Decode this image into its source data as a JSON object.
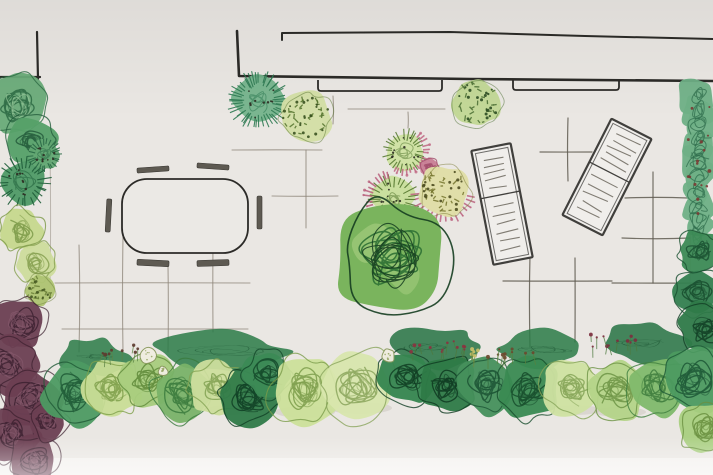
{
  "scene": {
    "description": "Hand-drawn garden landscape plan, top view, watercolor and ink sketch",
    "canvas": {
      "width": 713,
      "height": 475
    }
  },
  "palette": {
    "paper": "#eae7e3",
    "paper_light": "#f3f1ee",
    "ink": "#2c2b28",
    "pencil_light": "#8c8478",
    "pencil_dark": "#5f5a50",
    "seat": "#5e5a52",
    "lounger_frame": "#403f3c",
    "lounger_slat": "#7b766d",
    "lounger_fill": "#f0eeeb",
    "table_fill": "#ebe9e5",
    "pink": "#bd6280",
    "shadow": "#c2bdb5"
  },
  "building": {
    "rooftick": [
      [
        282,
        40
      ],
      [
        282,
        33
      ],
      [
        450,
        32
      ],
      [
        585,
        36
      ],
      [
        713,
        39
      ]
    ],
    "wall": [
      [
        237,
        31
      ],
      [
        239,
        76
      ],
      [
        470,
        79
      ],
      [
        713,
        81
      ]
    ],
    "corner_left_h": [
      [
        0,
        77
      ],
      [
        40,
        77
      ]
    ],
    "corner_left_v": [
      [
        37,
        32
      ],
      [
        38,
        79
      ]
    ],
    "doors": [
      {
        "name": "door-threshold-left",
        "x": 318,
        "y": 80,
        "w": 124,
        "h": 11
      },
      {
        "name": "door-threshold-right",
        "x": 513,
        "y": 79,
        "w": 106,
        "h": 11
      }
    ],
    "bed_edges": [
      [
        50,
        150,
        50,
        285
      ],
      [
        689,
        120,
        690,
        300
      ]
    ]
  },
  "paving": {
    "light_lines": [
      [
        79,
        245,
        79,
        352
      ],
      [
        123,
        237,
        123,
        352
      ],
      [
        168,
        265,
        168,
        352
      ],
      [
        213,
        243,
        213,
        332
      ],
      [
        55,
        283,
        250,
        283
      ],
      [
        62,
        329,
        248,
        329
      ],
      [
        232,
        150,
        322,
        150
      ],
      [
        306,
        150,
        306,
        228
      ],
      [
        272,
        196,
        338,
        196
      ],
      [
        348,
        109,
        445,
        109
      ],
      [
        408,
        112,
        408,
        128
      ],
      [
        333,
        96,
        333,
        124
      ]
    ],
    "dark_lines": [
      [
        540,
        152,
        592,
        152
      ],
      [
        568,
        118,
        568,
        181
      ],
      [
        625,
        198,
        688,
        198
      ],
      [
        653,
        172,
        653,
        283
      ],
      [
        622,
        238,
        690,
        238
      ],
      [
        530,
        255,
        530,
        347
      ],
      [
        575,
        258,
        575,
        342
      ],
      [
        503,
        281,
        612,
        281
      ],
      [
        612,
        283,
        702,
        283
      ]
    ]
  },
  "furniture": {
    "table": {
      "name": "dining-table",
      "x": 122,
      "y": 179,
      "w": 126,
      "h": 74,
      "r": 25
    },
    "seats": [
      {
        "name": "bench-top-left",
        "x": 137,
        "y": 167,
        "w": 32,
        "h": 5,
        "a": -4
      },
      {
        "name": "bench-top-right",
        "x": 197,
        "y": 164,
        "w": 32,
        "h": 5,
        "a": 4
      },
      {
        "name": "bench-bottom-left",
        "x": 137,
        "y": 260,
        "w": 32,
        "h": 6,
        "a": 3
      },
      {
        "name": "bench-bottom-right",
        "x": 197,
        "y": 260,
        "w": 32,
        "h": 6,
        "a": -2
      },
      {
        "name": "bench-left",
        "x": 106,
        "y": 199,
        "w": 5,
        "h": 33,
        "a": 3
      },
      {
        "name": "bench-right",
        "x": 257,
        "y": 196,
        "w": 5,
        "h": 33,
        "a": 0
      }
    ],
    "loungers": [
      {
        "name": "sun-lounger-left",
        "cx": 502,
        "cy": 204,
        "w": 40,
        "h": 116,
        "a": -11,
        "div": 0.42,
        "slats_top": 5,
        "slats_bottom": 6
      },
      {
        "name": "sun-lounger-right",
        "cx": 607,
        "cy": 177,
        "w": 45,
        "h": 108,
        "a": 27,
        "div": 0.45,
        "slats_top": 5,
        "slats_bottom": 5
      }
    ]
  },
  "shadows": [
    [
      305,
      412,
      30,
      6
    ],
    [
      360,
      408,
      32,
      6
    ],
    [
      230,
      410,
      24,
      5
    ],
    [
      150,
      400,
      22,
      5
    ],
    [
      575,
      410,
      26,
      5
    ],
    [
      620,
      412,
      26,
      5
    ]
  ],
  "bands": [
    {
      "x0": 62,
      "x1": 130,
      "y": 357,
      "h": 9,
      "color": "#2a7a46"
    },
    {
      "x0": 155,
      "x1": 285,
      "y": 352,
      "h": 10,
      "color": "#2a7a46"
    },
    {
      "x0": 388,
      "x1": 478,
      "y": 347,
      "h": 10,
      "color": "#267243"
    },
    {
      "x0": 498,
      "x1": 590,
      "y": 350,
      "h": 9,
      "color": "#2a7a46"
    },
    {
      "x0": 598,
      "x1": 688,
      "y": 344,
      "h": 10,
      "color": "#267243"
    }
  ],
  "plants": [
    {
      "name": "left-bed-shrub-1",
      "type": "scribble",
      "cx": 17,
      "cy": 105,
      "r": 30,
      "base": "#69ab78",
      "dark": "#2c6a43",
      "light": "#9ccb9e"
    },
    {
      "name": "left-bed-shrub-2",
      "type": "scribble",
      "cx": 32,
      "cy": 142,
      "r": 26,
      "base": "#55a068",
      "dark": "#245c3c"
    },
    {
      "name": "left-bed-shrub-3",
      "type": "spiky",
      "cx": 24,
      "cy": 182,
      "r": 24,
      "base": "#4f9a66",
      "spike": "#1e5c38"
    },
    {
      "name": "left-bed-shrub-4",
      "type": "spiky",
      "cx": 44,
      "cy": 155,
      "r": 16,
      "base": "#63a873",
      "spike": "#2a6a46"
    },
    {
      "name": "left-bed-shrub-5",
      "type": "lightscribble",
      "cx": 20,
      "cy": 230,
      "r": 22,
      "base": "#c6d88d",
      "dark": "#7d9a49"
    },
    {
      "name": "left-bed-shrub-6",
      "type": "lightscribble",
      "cx": 36,
      "cy": 262,
      "r": 20,
      "base": "#cddc9c",
      "dark": "#86a050"
    },
    {
      "name": "left-bed-shrub-7",
      "type": "textured",
      "cx": 40,
      "cy": 290,
      "r": 15,
      "base": "#aec473",
      "mark": "#6b8039",
      "dot": "#465922"
    },
    {
      "name": "left-bed-maroon-mass",
      "type": "mass",
      "base": "#6b3f52",
      "dark": "#3a1f2e",
      "light": "#8d6073",
      "subs": [
        [
          20,
          322,
          26
        ],
        [
          8,
          365,
          28
        ],
        [
          30,
          398,
          30
        ],
        [
          12,
          436,
          28
        ],
        [
          34,
          460,
          24
        ],
        [
          48,
          420,
          20
        ]
      ]
    },
    {
      "name": "tree-teal-spiky",
      "type": "spiky",
      "cx": 258,
      "cy": 101,
      "r": 27,
      "base": "#74b38b",
      "spike": "#2e7a52",
      "dense": true
    },
    {
      "name": "tree-textured-left",
      "type": "textured",
      "cx": 306,
      "cy": 117,
      "r": 26,
      "base": "#d2dfa5",
      "mark": "#55742e",
      "dot": "#3a5220"
    },
    {
      "name": "tree-textured-right",
      "type": "textured",
      "cx": 477,
      "cy": 103,
      "r": 24,
      "base": "#c1d795",
      "mark": "#4a6e32",
      "dot": "#2e4e23"
    },
    {
      "name": "shrub-spiky-upper",
      "type": "spiky",
      "cx": 405,
      "cy": 151,
      "r": 20,
      "base": "#cfe2a1",
      "spike": "#5a7d36",
      "fringe": {
        "a0": -50,
        "a1": 120,
        "color": "#c06883"
      }
    },
    {
      "name": "pink-tuft",
      "type": "lightscribble",
      "cx": 429,
      "cy": 167,
      "r": 9,
      "base": "#c87e95",
      "dark": "#a34e6c"
    },
    {
      "name": "shrub-spiky-lower",
      "type": "spiky",
      "cx": 393,
      "cy": 199,
      "r": 23,
      "base": "#c8de9b",
      "spike": "#54772e",
      "fringe": {
        "a0": 100,
        "a1": 260,
        "color": "#b85e7b"
      }
    },
    {
      "name": "shrub-yellow-textured",
      "type": "textured",
      "cx": 444,
      "cy": 191,
      "r": 26,
      "base": "#dfdea7",
      "mark": "#75752e",
      "dot": "#4e4e21",
      "fringe": {
        "a0": 10,
        "a1": 175,
        "color": "#bc6380"
      }
    },
    {
      "name": "shrub-cloud-topiary",
      "type": "cloud",
      "cx": 392,
      "cy": 257,
      "r": 56,
      "base": "#7ab45d",
      "dark": "#2e7034",
      "ink": "#153d20",
      "light": "#a6cd80"
    },
    {
      "name": "right-hedge-top",
      "type": "hedge",
      "x": 684,
      "w": 29,
      "y0": 88,
      "y1": 232,
      "base": "#6fb086",
      "dark": "#2b6a49",
      "berry": "#7a3a33"
    },
    {
      "name": "right-hedge-mid-1",
      "type": "scribble",
      "cx": 700,
      "cy": 252,
      "r": 22,
      "base": "#3c8a55",
      "dark": "#1b5232"
    },
    {
      "name": "right-hedge-mid-2",
      "type": "scribble",
      "cx": 697,
      "cy": 292,
      "r": 24,
      "base": "#348050",
      "dark": "#174c2e"
    },
    {
      "name": "right-hedge-mid-3",
      "type": "scribble",
      "cx": 704,
      "cy": 328,
      "r": 26,
      "base": "#2f7a49",
      "dark": "#133f26"
    },
    {
      "name": "border-shrub-1",
      "type": "scribble",
      "cx": 73,
      "cy": 393,
      "r": 32,
      "base": "#4d9a62",
      "dark": "#1f5936"
    },
    {
      "name": "border-shrub-2",
      "type": "lightscribble",
      "cx": 112,
      "cy": 388,
      "r": 29,
      "base": "#c9dd96",
      "dark": "#7fa04b"
    },
    {
      "name": "border-shrub-3",
      "type": "lightscribble",
      "cx": 148,
      "cy": 380,
      "r": 26,
      "base": "#a8cc7d",
      "dark": "#5f8a3a"
    },
    {
      "name": "border-shrub-4",
      "type": "scribble",
      "cx": 183,
      "cy": 393,
      "r": 30,
      "base": "#79b268",
      "dark": "#3a7a3d"
    },
    {
      "name": "border-shrub-5",
      "type": "lightscribble",
      "cx": 217,
      "cy": 388,
      "r": 27,
      "base": "#cede9d",
      "dark": "#83a253"
    },
    {
      "name": "border-shrub-6",
      "type": "scribble",
      "cx": 249,
      "cy": 398,
      "r": 29,
      "base": "#2f7a48",
      "dark": "#103f24"
    },
    {
      "name": "border-shrub-7",
      "type": "scribble",
      "cx": 267,
      "cy": 374,
      "r": 23,
      "base": "#3c8a55",
      "dark": "#14492a"
    },
    {
      "name": "border-shrub-8",
      "type": "lightscribble",
      "cx": 305,
      "cy": 390,
      "r": 34,
      "base": "#cce09a",
      "dark": "#7b9c4a"
    },
    {
      "name": "border-shrub-9",
      "type": "lightscribble",
      "cx": 358,
      "cy": 386,
      "r": 36,
      "base": "#d8e6ad",
      "dark": "#8aa55c"
    },
    {
      "name": "border-shrub-10",
      "type": "scribble",
      "cx": 407,
      "cy": 378,
      "r": 28,
      "base": "#35854f",
      "dark": "#123f25"
    },
    {
      "name": "border-shrub-11",
      "type": "scribble",
      "cx": 447,
      "cy": 384,
      "r": 29,
      "base": "#2e7a47",
      "dark": "#0f3a21"
    },
    {
      "name": "border-shrub-12",
      "type": "scribble",
      "cx": 487,
      "cy": 385,
      "r": 30,
      "base": "#46905c",
      "dark": "#1c5434"
    },
    {
      "name": "border-shrub-13",
      "type": "scribble",
      "cx": 528,
      "cy": 390,
      "r": 31,
      "base": "#3a8a52",
      "dark": "#164c2c"
    },
    {
      "name": "border-shrub-14",
      "type": "lightscribble",
      "cx": 572,
      "cy": 389,
      "r": 29,
      "base": "#cfe2a1",
      "dark": "#85a457"
    },
    {
      "name": "border-shrub-15",
      "type": "lightscribble",
      "cx": 616,
      "cy": 390,
      "r": 31,
      "base": "#b4d488",
      "dark": "#6d9445"
    },
    {
      "name": "border-shrub-16",
      "type": "scribble",
      "cx": 657,
      "cy": 388,
      "r": 30,
      "base": "#7fb96b",
      "dark": "#3f7e3e"
    },
    {
      "name": "border-shrub-17",
      "type": "scribble",
      "cx": 695,
      "cy": 380,
      "r": 33,
      "base": "#4c9a60",
      "dark": "#1d5736"
    },
    {
      "name": "border-shrub-18",
      "type": "lightscribble",
      "cx": 706,
      "cy": 428,
      "r": 26,
      "base": "#a9cf7f",
      "dark": "#6a9040"
    }
  ],
  "flowerballs": [
    {
      "name": "white-flower-ball-1",
      "cx": 149,
      "cy": 355,
      "r": 9
    },
    {
      "name": "white-flower-ball-2",
      "cx": 163,
      "cy": 371,
      "r": 5
    },
    {
      "name": "white-flower-ball-3",
      "cx": 388,
      "cy": 356,
      "r": 7
    }
  ],
  "sprigs": [
    {
      "name": "flower-sprig-red-center",
      "cx": 438,
      "cy": 347,
      "spread": 28,
      "n": 12,
      "dot": "#8a3340",
      "stem": "#4d7a3f"
    },
    {
      "name": "flower-sprig-red-right",
      "cx": 612,
      "cy": 341,
      "spread": 28,
      "n": 11,
      "dot": "#7c2f3f",
      "stem": "#4d7a3f"
    },
    {
      "name": "flower-sprig-mixed",
      "cx": 510,
      "cy": 352,
      "spread": 24,
      "n": 10,
      "dot": "#6b4a2f",
      "stem": "#57813f"
    },
    {
      "name": "flower-sprig-left",
      "cx": 120,
      "cy": 350,
      "spread": 22,
      "n": 8,
      "dot": "#5d3b2f",
      "stem": "#5d8446"
    },
    {
      "name": "flower-sprig-yellow",
      "cx": 480,
      "cy": 352,
      "spread": 10,
      "n": 5,
      "dot": "#c9c06a",
      "stem": "#6b8a3f"
    }
  ]
}
